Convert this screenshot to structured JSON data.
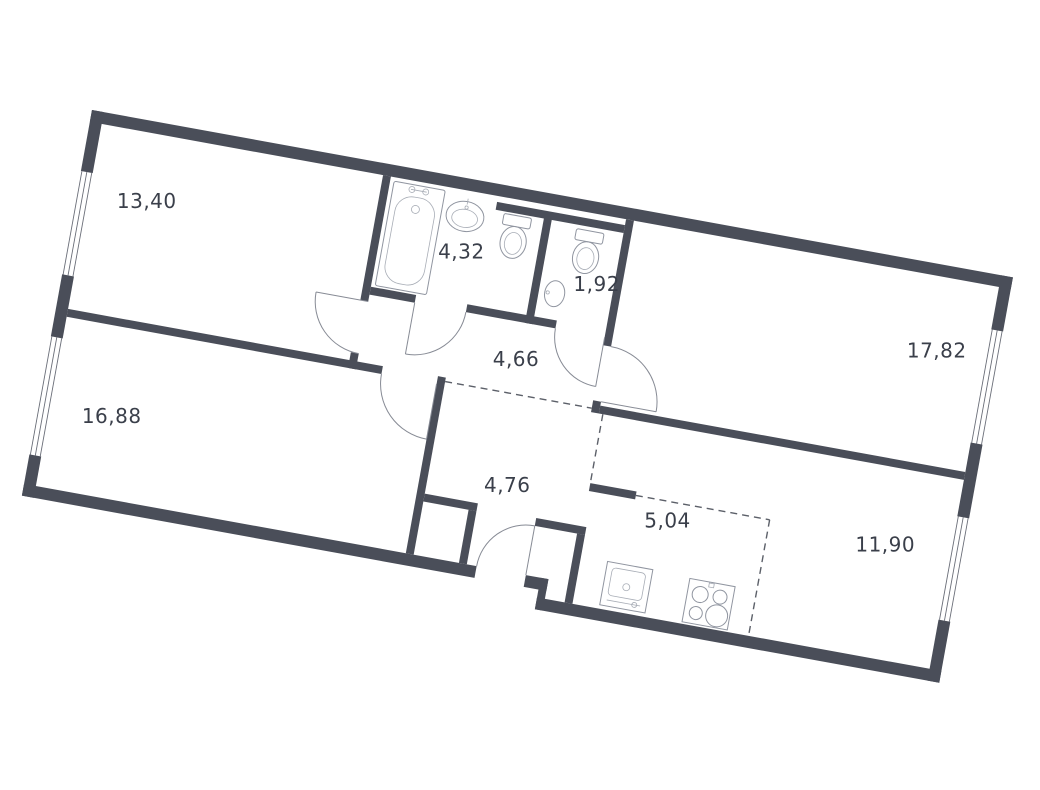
{
  "plan": {
    "type": "apartment-floor-plan",
    "rotation_deg": 10.3,
    "colors": {
      "wall": "#4a4e59",
      "fixture_line": "#9095a0",
      "door_arc": "#878b95",
      "dashed_zone_line": "#5c6069",
      "label": "#3a3f4a",
      "background": "#ffffff"
    },
    "rooms": {
      "bedroom_top_left": {
        "label": "13,40"
      },
      "bathroom": {
        "label": "4,32"
      },
      "wc": {
        "label": "1,92"
      },
      "living_right": {
        "label": "17,82"
      },
      "hallway": {
        "label": "4,66"
      },
      "bedroom_bottom_left": {
        "label": "16,88"
      },
      "corridor": {
        "label": "4,76"
      },
      "kitchen": {
        "label": "5,04"
      },
      "room_bottom_right": {
        "label": "11,90"
      }
    },
    "fixtures": [
      "bathtub",
      "washbasin",
      "toilet",
      "toilet-small",
      "corner-sink",
      "kitchen-sink",
      "stove-4-burner"
    ],
    "openings": [
      "window-left-top",
      "window-left-bottom",
      "window-right-top",
      "window-right-bottom",
      "entrance-door",
      "room-doors-x5"
    ]
  }
}
